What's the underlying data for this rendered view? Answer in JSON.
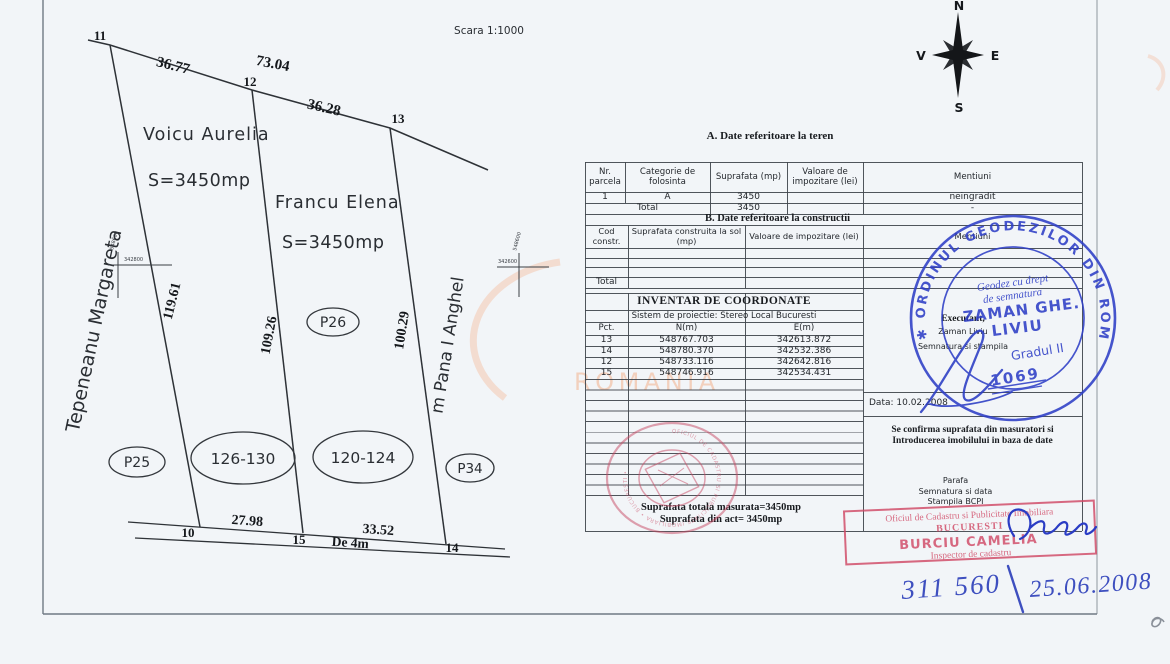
{
  "scale_label": "Scara 1:1000",
  "compass": {
    "n": "N",
    "e": "E",
    "s": "S",
    "v": "V"
  },
  "plan": {
    "pt11": "11",
    "pt12": "12",
    "pt13": "13",
    "pt10": "10",
    "pt15": "15",
    "pt14": "14",
    "dim_11_12": "36.77",
    "dim_11_13": "73.04",
    "dim_12_13": "36.28",
    "dim_left": "119.61",
    "dim_mid": "109.26",
    "dim_right": "100.29",
    "dim_10_15": "27.98",
    "dim_15_14": "33.52",
    "road_label": "De 4m",
    "owner_far_left": "Tepeneanu Margareta",
    "owner_far_right": "m Pana I Anghel",
    "parcel1_owner": "Voicu Aurelia",
    "parcel1_area": "S=3450mp",
    "parcel2_owner": "Francu Elena",
    "parcel2_area": "S=3450mp",
    "ellipse_p25": "P25",
    "ellipse_126_130": "126-130",
    "ellipse_120_124": "120-124",
    "ellipse_p34": "P34",
    "ellipse_p26": "P26",
    "grid_cross1_n": "548600",
    "grid_cross1_e": "342800",
    "grid_cross2_n": "548600",
    "grid_cross2_e": "342600"
  },
  "watermark": {
    "text": "ROMANIA"
  },
  "section_a": {
    "title": "A. Date referitoare la teren",
    "col_nr": "Nr. parcela",
    "col_categorie": "Categorie de folosinta",
    "col_suprafata": "Suprafata (mp)",
    "col_valoare": "Valoare de impozitare (lei)",
    "col_mentiuni": "Mentiuni",
    "row1_nr": "1",
    "row1_categorie": "A",
    "row1_suprafata": "3450",
    "row1_mentiuni": "neingradit",
    "total_label": "Total",
    "total_suprafata": "3450",
    "total_mentiuni": "-"
  },
  "section_b": {
    "title": "B. Date referitoare la constructii",
    "col_cod": "Cod constr.",
    "col_suprafata": "Suprafata construita la sol (mp)",
    "col_valoare": "Valoare de impozitare (lei)",
    "col_mentiuni": "Mentiuni",
    "total_label": "Total"
  },
  "coords": {
    "title": "INVENTAR DE COORDONATE",
    "subtitle": "Sistem de proiectie: Stereo Local Bucuresti",
    "col_pct": "Pct.",
    "col_n": "N(m)",
    "col_e": "E(m)",
    "rows": [
      {
        "pct": "13",
        "n": "548767.703",
        "e": "342613.872"
      },
      {
        "pct": "14",
        "n": "548780.370",
        "e": "342532.386"
      },
      {
        "pct": "12",
        "n": "548733.116",
        "e": "342642.816"
      },
      {
        "pct": "15",
        "n": "548746.916",
        "e": "342534.431"
      }
    ]
  },
  "executant": {
    "label": "Executant,",
    "name": "Zaman Liviu",
    "sig_label": "Semnatura si stampila",
    "date": "Data: 10.02.2008"
  },
  "confirm": {
    "line1": "Se confirma suprafata din masuratori si",
    "line2": "Introducerea imobilului in baza de date",
    "parafa": "Parafa",
    "semnatura": "Semnatura si data",
    "stampila": "Stampila BCPI"
  },
  "totals": {
    "line1": "Suprafata totala masurata=3450mp",
    "line2": "Suprafata din act= 3450mp"
  },
  "stamps": {
    "blue_round": {
      "ring": "✱ ORDINUL GEODEZILOR DIN ROMÂNIA",
      "line1": "Geodez cu drept",
      "line2": "de semnatura",
      "name_line1": "ZAMAN GHE.",
      "name_line2": "LIVIU",
      "grade": "Gradul II",
      "number": "1069"
    },
    "red_round": {
      "ring": "OFICIUL DE CADASTRU SI PUBLICITATE IMOBILIARA • BUCURESTI •"
    },
    "red_rect": {
      "line1": "Oficiul de Cadastru si Publicitate Imobiliara",
      "line2": "BUCURESTI",
      "line3": "BURCIU CAMELIA",
      "line4": "Inspector de cadastru"
    }
  },
  "handwriting": {
    "number": "311 560",
    "date": "25.06.2008"
  }
}
